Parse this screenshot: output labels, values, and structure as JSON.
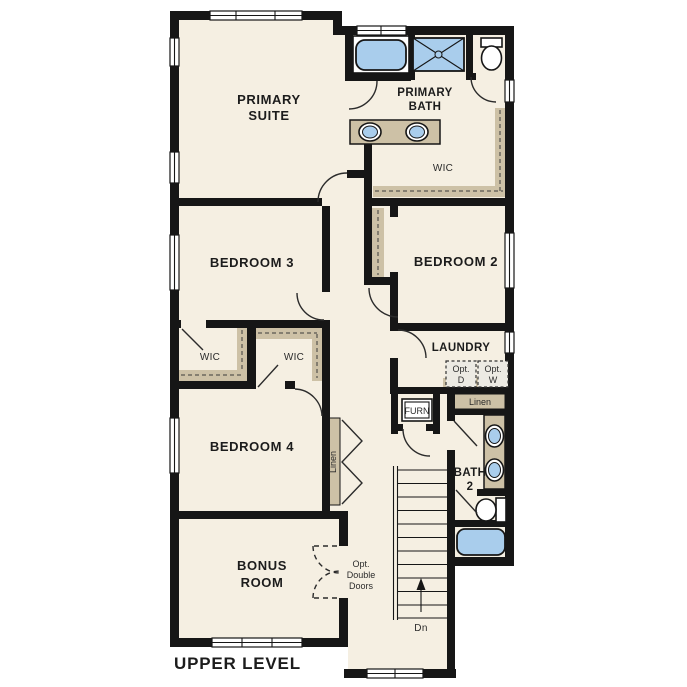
{
  "title": "UPPER LEVEL",
  "colors": {
    "wall": "#161616",
    "floor": "#f5efe2",
    "shelf": "#cdc1a6",
    "fixture": "#a9cdec",
    "optbox": "#eceae3"
  },
  "rooms": {
    "primary_suite": [
      "PRIMARY",
      "SUITE"
    ],
    "primary_bath": [
      "PRIMARY",
      "BATH"
    ],
    "wic_primary": "WIC",
    "bedroom3": "BEDROOM 3",
    "bedroom2": "BEDROOM 2",
    "laundry": "LAUNDRY",
    "wic_left": "WIC",
    "wic_right": "WIC",
    "bedroom4": "BEDROOM 4",
    "bath2": [
      "BATH",
      "2"
    ],
    "bonus": [
      "BONUS",
      "ROOM"
    ]
  },
  "annotations": {
    "opt_dryer": [
      "Opt.",
      "D"
    ],
    "opt_washer": [
      "Opt.",
      "W"
    ],
    "linen_laundry": "Linen",
    "linen_hall": "Linen",
    "furnace": "FURN",
    "stairs_dn": "Dn",
    "opt_double_doors": [
      "Opt.",
      "Double",
      "Doors"
    ]
  }
}
